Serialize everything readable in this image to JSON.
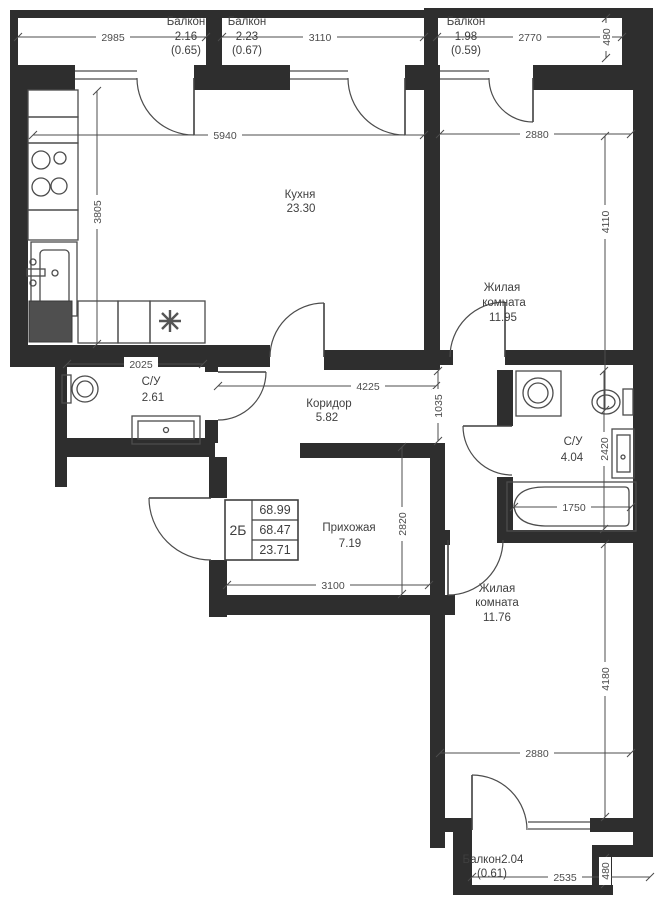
{
  "plan_type": "apartment-floor-plan",
  "info_box": {
    "unit_type": "2Б",
    "row1": "68.99",
    "row2": "68.47",
    "row3": "23.71"
  },
  "rooms": {
    "balcony1": {
      "name": "Балкон",
      "area": "2.16",
      "reduced": "(0.65)"
    },
    "balcony2": {
      "name": "Балкон",
      "area": "2.23",
      "reduced": "(0.67)"
    },
    "balcony3": {
      "name": "Балкон",
      "area": "1.98",
      "reduced": "(0.59)"
    },
    "kitchen": {
      "name": "Кухня",
      "area": "23.30"
    },
    "living1": {
      "name_line1": "Жилая",
      "name_line2": "комната",
      "area": "11.95"
    },
    "bath1": {
      "name": "С/У",
      "area": "2.61"
    },
    "corridor": {
      "name": "Коридор",
      "area": "5.82"
    },
    "bath2": {
      "name": "С/У",
      "area": "4.04"
    },
    "hallway": {
      "name": "Прихожая",
      "area": "7.19"
    },
    "living2": {
      "name_line1": "Жилая",
      "name_line2": "комната",
      "area": "11.76"
    },
    "balcony4": {
      "name": "Балкон2.04",
      "reduced": "(0.61)"
    }
  },
  "dims": {
    "balcony1_width": "2985",
    "balcony2_width": "3110",
    "balcony3_width": "2770",
    "balcony3_depth": "480",
    "kitchen_width": "5940",
    "kitchen_height": "3805",
    "living1_width": "2880",
    "living1_height": "4110",
    "bath1_width": "2025",
    "corridor_width": "4225",
    "corridor_opening": "1035",
    "bath2_height": "2420",
    "bathtub_width": "1750",
    "hallway_height": "2820",
    "hallway_width": "3100",
    "living2_width": "2880",
    "living2_height": "4180",
    "balcony4_width": "2535",
    "balcony4_depth": "480"
  },
  "colors": {
    "wall": "#2e2e2e",
    "line": "#4c4c4c",
    "label": "#3f3f3f",
    "background": "#ffffff"
  }
}
